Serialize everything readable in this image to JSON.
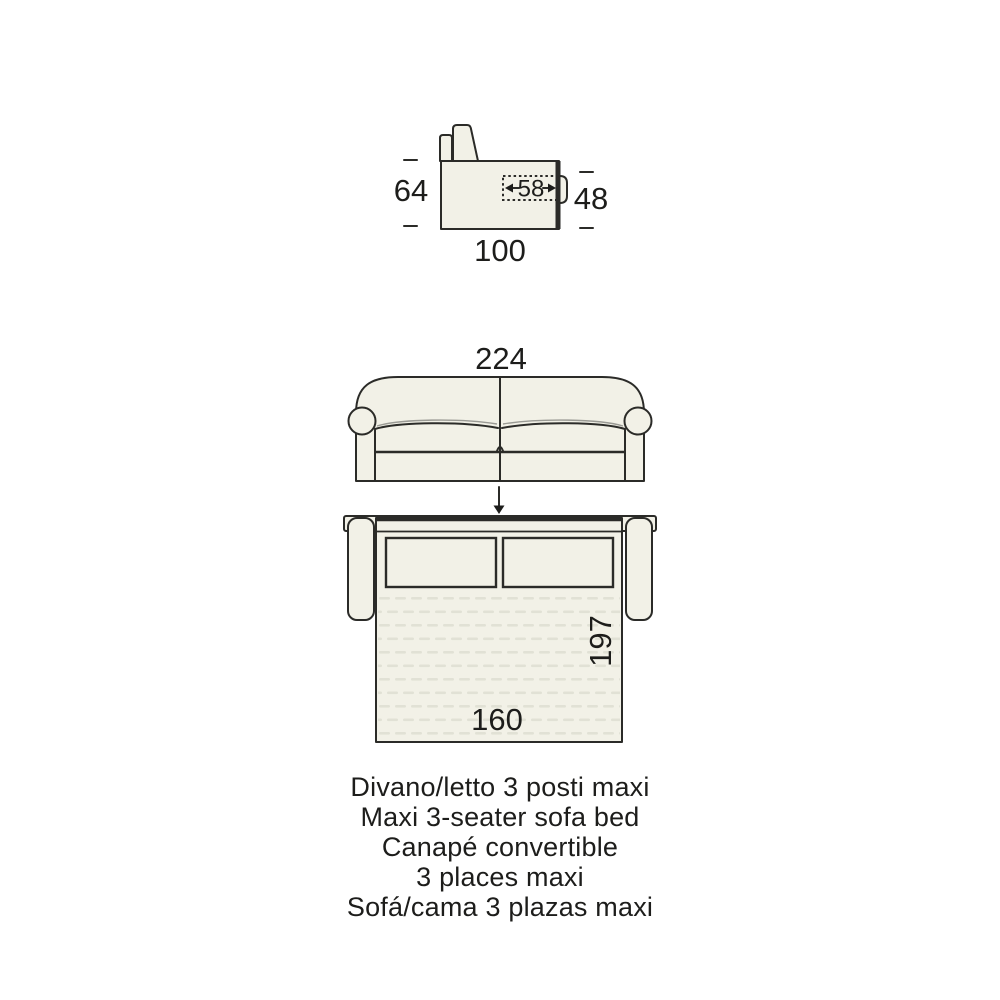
{
  "title": "Sofa bed dimensions diagram",
  "colors": {
    "background": "#ffffff",
    "line": "#2b2b28",
    "shape_fill": "#f2f1e7",
    "mattress_dash": "#e1e1d5",
    "text": "#1d1d1b"
  },
  "side_view": {
    "total_height": "64",
    "seat_height": "48",
    "total_depth": "100",
    "folded_bed_depth": "58"
  },
  "front_view": {
    "total_width": "224"
  },
  "open_view": {
    "bed_length": "197",
    "bed_width": "160"
  },
  "captions": [
    "Divano/letto 3 posti maxi",
    "Maxi 3-seater sofa bed",
    "Canapé convertible",
    "3 places maxi",
    "Sofá/cama 3 plazas maxi"
  ]
}
